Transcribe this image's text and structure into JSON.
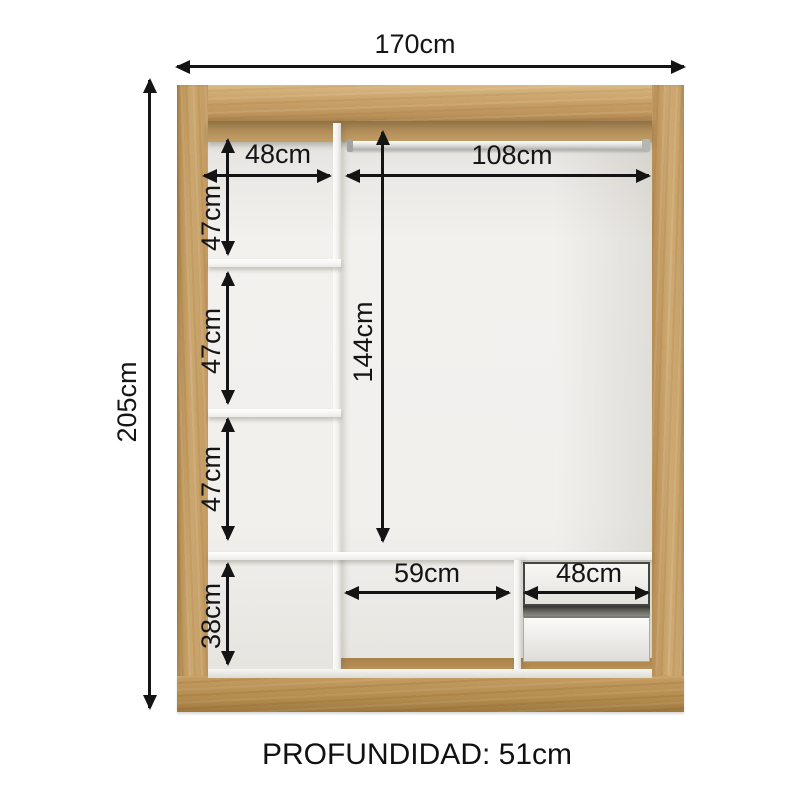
{
  "diagram_title": "wardrobe-internal-dimensions",
  "dims": {
    "total_width": "170cm",
    "total_height": "205cm",
    "left_col_width": "48cm",
    "rod_section_width": "108cm",
    "left_sec1": "47cm",
    "left_sec2": "47cm",
    "left_sec3": "47cm",
    "left_sec4": "38cm",
    "rod_section_height": "144cm",
    "bottom_open_width": "59cm",
    "drawer_unit_width": "48cm"
  },
  "footer": {
    "depth_text": "PROFUNDIDAD: 51cm"
  },
  "colors": {
    "wood": "#c59e66",
    "wood_dark": "#ab834c",
    "interior": "#f2f1ee",
    "panel_white": "#fbfbfa",
    "dimension_line": "#141414",
    "background": "#ffffff"
  }
}
